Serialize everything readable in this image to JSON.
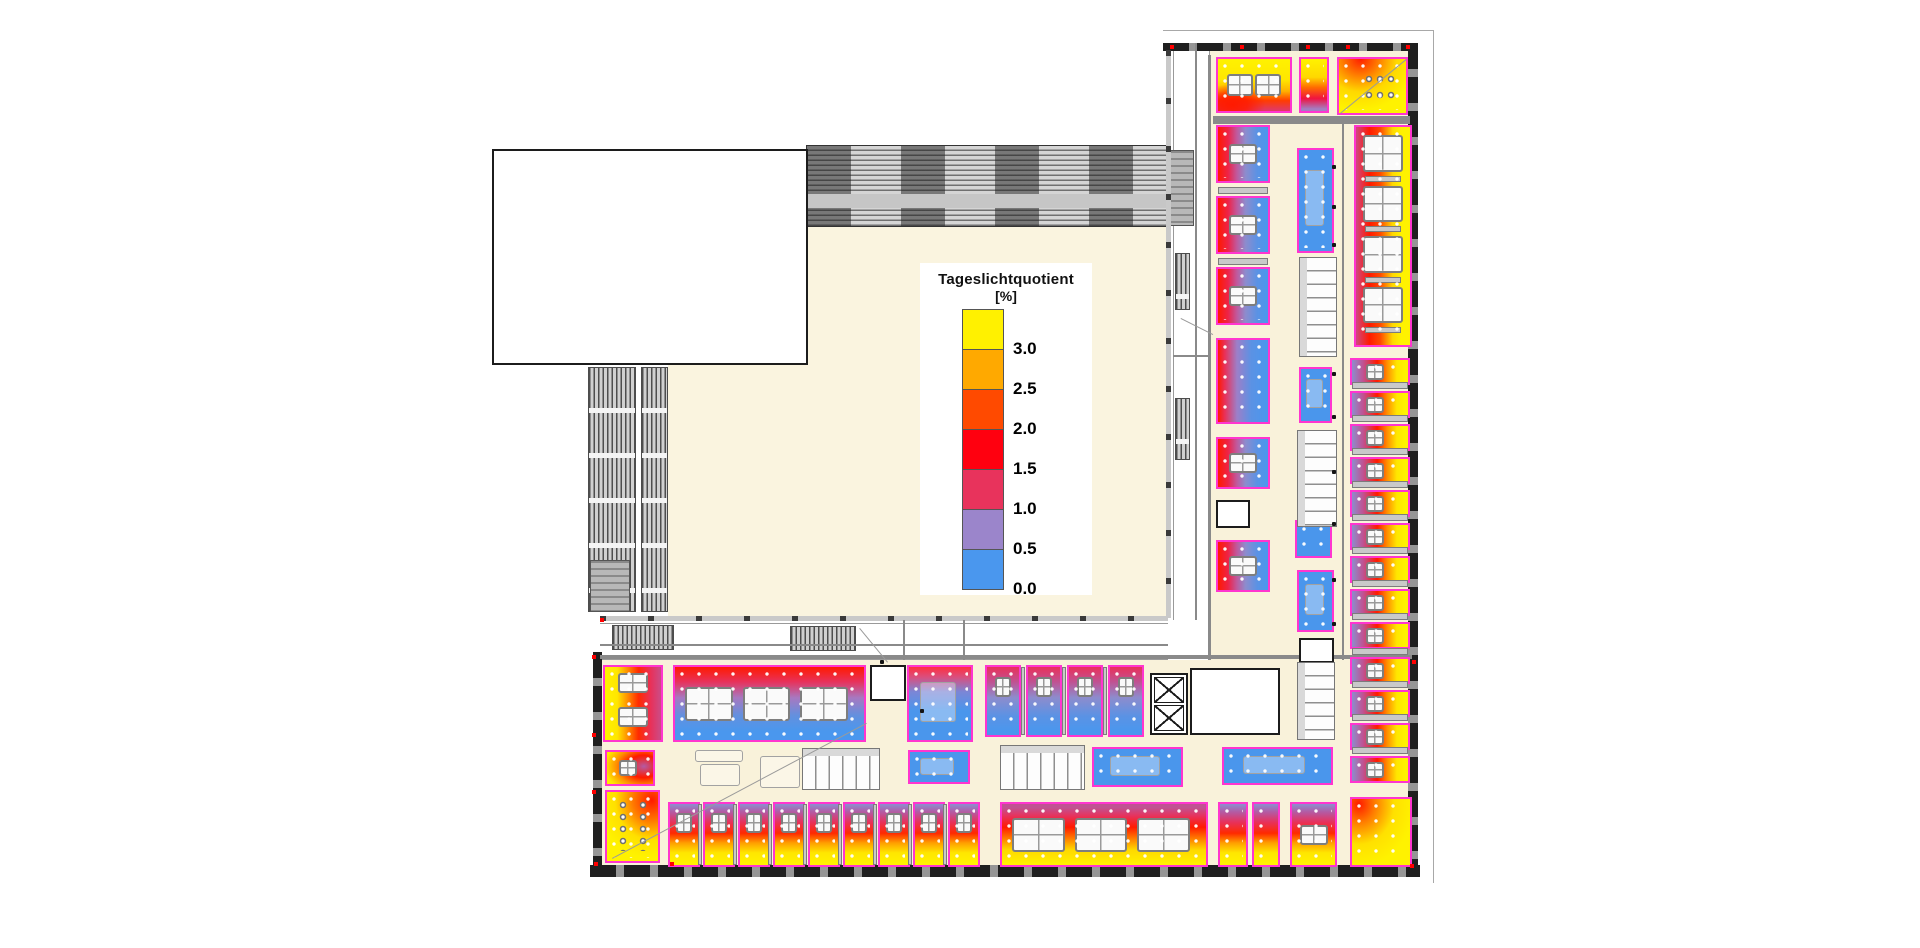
{
  "legend": {
    "title": "Tageslichtquotient",
    "unit": "[%]",
    "entries": [
      {
        "label": "3.0",
        "color": "#fff100"
      },
      {
        "label": "2.5",
        "color": "#ffa900"
      },
      {
        "label": "2.0",
        "color": "#ff4a00"
      },
      {
        "label": "1.5",
        "color": "#ff000f"
      },
      {
        "label": "1.0",
        "color": "#e8335c"
      },
      {
        "label": "0.5",
        "color": "#9b85cb"
      },
      {
        "label": "0.0",
        "color": "#4a97ee"
      }
    ],
    "box": {
      "x": 920,
      "y": 263,
      "w": 172,
      "h": 332
    }
  },
  "plan": {
    "colors": {
      "floor_cream": "#f9f2da",
      "courtyard_cream": "#faf4df",
      "room_border_magenta": "#ff35cf",
      "wall_dark": "#1f1f1f",
      "heat_max_yellow": "#fff100",
      "heat_mid_red": "#ff000f",
      "heat_min_blue": "#4a97ee"
    },
    "boundary": [
      [
        1163,
        30,
        271,
        1
      ],
      [
        1433,
        30,
        1,
        853
      ]
    ],
    "floors": [
      [
        1210,
        50,
        200,
        612
      ],
      [
        600,
        660,
        815,
        207
      ],
      [
        862,
        660,
        50,
        88
      ]
    ],
    "court": [
      668,
      227,
      500,
      391
    ],
    "whiteStrips": [
      [
        1173,
        43,
        37,
        577,
        "v"
      ],
      [
        600,
        623,
        568,
        37,
        "h"
      ]
    ],
    "band": [
      806,
      145,
      364,
      82
    ],
    "louvers": [
      [
        588,
        367,
        48,
        245
      ],
      [
        641,
        367,
        27,
        245
      ],
      [
        1175,
        253,
        15,
        57
      ],
      [
        1175,
        398,
        15,
        62
      ],
      [
        612,
        625,
        62,
        25
      ],
      [
        790,
        626,
        66,
        25
      ]
    ],
    "grayBlocks": [
      [
        1168,
        150,
        26,
        76
      ],
      [
        590,
        560,
        40,
        52
      ]
    ],
    "walls": {
      "tickDarkH": [
        [
          1163,
          43,
          255,
          8
        ],
        [
          590,
          865,
          830,
          12
        ]
      ],
      "tickDarkV": [
        [
          1408,
          43,
          10,
          830
        ],
        [
          593,
          652,
          9,
          215
        ]
      ],
      "tickLightH": [
        [
          600,
          616,
          568,
          5
        ]
      ],
      "tickLightV": [
        [
          1166,
          50,
          5,
          568
        ]
      ],
      "plain": [
        [
          1208,
          55,
          3,
          605
        ],
        [
          1195,
          43,
          2,
          577
        ],
        [
          903,
          620,
          2,
          40
        ],
        [
          963,
          620,
          2,
          40
        ],
        [
          600,
          644,
          568,
          2
        ],
        [
          1173,
          355,
          37,
          2
        ],
        [
          1213,
          116,
          197,
          8
        ],
        [
          600,
          655,
          812,
          4
        ],
        [
          1342,
          120,
          2,
          540
        ]
      ]
    },
    "rooms": [
      [
        1216,
        57,
        76,
        56,
        "g-northA",
        "d2r"
      ],
      [
        1299,
        57,
        30,
        56,
        "g-north2",
        ""
      ],
      [
        1337,
        57,
        71,
        58,
        "g-ne",
        "ch"
      ],
      [
        1216,
        338,
        54,
        86,
        "g-rb",
        ""
      ],
      [
        1216,
        437,
        54,
        52,
        "g-west",
        "d1"
      ],
      [
        1216,
        540,
        54,
        52,
        "g-west",
        "d1"
      ],
      [
        1354,
        125,
        58,
        222,
        "g-eastbig",
        "d4c"
      ],
      [
        1350,
        797,
        62,
        70,
        "g-se",
        ""
      ],
      [
        673,
        665,
        193,
        77,
        "g-inner",
        "d3r"
      ],
      [
        907,
        665,
        66,
        77,
        "g-bluetop",
        "skt"
      ],
      [
        603,
        665,
        60,
        77,
        "g-swof",
        "d2c"
      ],
      [
        605,
        750,
        50,
        36,
        "g-sws",
        "dm"
      ],
      [
        605,
        790,
        55,
        73,
        "g-swt",
        "cv"
      ],
      [
        1000,
        802,
        208,
        65,
        "g-southbig",
        "d3r"
      ],
      [
        1218,
        802,
        30,
        65,
        "g-south",
        ""
      ],
      [
        1252,
        802,
        28,
        65,
        "g-south",
        ""
      ],
      [
        1290,
        802,
        47,
        65,
        "g-south",
        "d1"
      ],
      [
        1297,
        148,
        37,
        105,
        "g-blue",
        "skt"
      ],
      [
        1299,
        367,
        33,
        56,
        "g-blue",
        "skt"
      ],
      [
        1295,
        520,
        37,
        38,
        "g-blue",
        ""
      ],
      [
        1297,
        570,
        37,
        62,
        "g-blue",
        "skt"
      ],
      [
        908,
        750,
        62,
        34,
        "g-blue",
        "skt"
      ],
      [
        1092,
        747,
        91,
        40,
        "g-blue",
        "skt"
      ],
      [
        1222,
        747,
        111,
        38,
        "g-blue",
        "skt"
      ]
    ],
    "officeGroups": [
      {
        "x": 1216,
        "w": 54,
        "h": 58,
        "ys": [
          125,
          196,
          267
        ],
        "g": "g-west",
        "f": "d1",
        "shelf": "h"
      },
      {
        "x": 1350,
        "w": 60,
        "h": 27,
        "ys": [
          358,
          391,
          424,
          457,
          490,
          523,
          556,
          589,
          622,
          657,
          690,
          723,
          756
        ],
        "g": "g-easts",
        "f": "dm",
        "shelf": "h"
      },
      {
        "y": 665,
        "h": 72,
        "w": 36,
        "xs": [
          985,
          1026,
          1067,
          1108
        ],
        "g": "g-court",
        "f": "dmv",
        "shelf": "v"
      },
      {
        "y": 802,
        "h": 65,
        "w": 32,
        "xs": [
          668,
          703,
          738,
          773,
          808,
          843,
          878,
          913,
          948
        ],
        "g": "g-south",
        "f": "dmv",
        "shelf": "v"
      }
    ],
    "whiteRooms": [
      [
        1216,
        500,
        34,
        28
      ],
      [
        870,
        665,
        36,
        36
      ],
      [
        1190,
        668,
        90,
        67
      ],
      [
        1299,
        638,
        35,
        25
      ]
    ],
    "wcV": [
      [
        1299,
        257,
        38,
        100
      ],
      [
        1297,
        430,
        40,
        97
      ],
      [
        1297,
        662,
        38,
        78
      ]
    ],
    "wcH": [
      [
        802,
        748,
        78,
        42
      ],
      [
        1000,
        745,
        85,
        45
      ]
    ],
    "elevators": [
      [
        1150,
        673,
        38,
        62
      ]
    ],
    "sketches": [
      [
        695,
        750,
        48,
        12
      ],
      [
        700,
        764,
        40,
        22
      ],
      [
        760,
        756,
        40,
        32
      ]
    ],
    "whiteBlock": [
      492,
      149,
      316,
      216
    ],
    "lines": [
      [
        612,
        858,
        866,
        723
      ],
      [
        1340,
        113,
        1406,
        59
      ],
      [
        860,
        628,
        888,
        662
      ],
      [
        1181,
        318,
        1213,
        334
      ]
    ],
    "redDots": [
      [
        592,
        655
      ],
      [
        592,
        733
      ],
      [
        592,
        790
      ],
      [
        594,
        862
      ],
      [
        670,
        862
      ],
      [
        1170,
        45
      ],
      [
        1240,
        45
      ],
      [
        1306,
        45
      ],
      [
        1346,
        45
      ],
      [
        1406,
        45
      ],
      [
        1412,
        660
      ],
      [
        1410,
        864
      ],
      [
        600,
        618
      ]
    ],
    "blackDots": [
      [
        1332,
        165
      ],
      [
        1332,
        205
      ],
      [
        1332,
        243
      ],
      [
        1332,
        372
      ],
      [
        1332,
        415
      ],
      [
        1332,
        470
      ],
      [
        1332,
        522
      ],
      [
        1332,
        578
      ],
      [
        1332,
        622
      ],
      [
        920,
        709
      ],
      [
        880,
        660
      ]
    ]
  }
}
